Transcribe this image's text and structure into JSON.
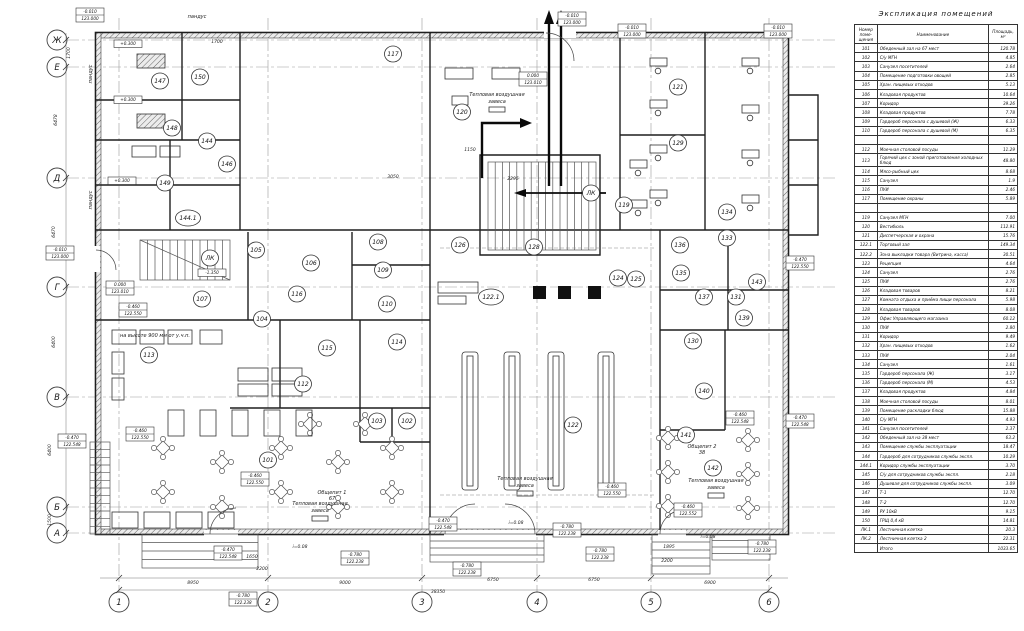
{
  "schedule": {
    "title": "Экспликация помещений",
    "headers": [
      "Номер поме- щения",
      "Наименование",
      "Площадь, м²"
    ],
    "rows": [
      [
        "101",
        "Обеденный зал на 67 мест",
        "120.78"
      ],
      [
        "102",
        "С/у МГН",
        "4.85"
      ],
      [
        "103",
        "Санузел посетителей",
        "2.64"
      ],
      [
        "104",
        "Помещение подготовки овощей",
        "2.85"
      ],
      [
        "105",
        "Хран. пищевых отходов",
        "5.13"
      ],
      [
        "106",
        "Кладовая продуктов",
        "10.64"
      ],
      [
        "107",
        "Коридор",
        "39.26"
      ],
      [
        "108",
        "Кладовая продуктов",
        "7.78"
      ],
      [
        "109",
        "Гардероб персонала с душевой (Ж)",
        "6.33"
      ],
      [
        "110",
        "Гардероб персонала с душевой (М)",
        "6.35"
      ],
      [
        "",
        "",
        ""
      ],
      [
        "112",
        "Моечная столовой посуды",
        "11.29"
      ],
      [
        "113",
        "Горячий цех с зоной приготовления холодных блюд",
        "48.80"
      ],
      [
        "114",
        "Мясо-рыбный цех",
        "8.68"
      ],
      [
        "115",
        "Санузел",
        "1.9"
      ],
      [
        "116",
        "ПУИ",
        "2.46"
      ],
      [
        "117",
        "Помещение охраны",
        "5.89"
      ],
      [
        "",
        "",
        ""
      ],
      [
        "119",
        "Санузел МГН",
        "7.00"
      ],
      [
        "120",
        "Вестибюль",
        "112.91"
      ],
      [
        "121",
        "Диспетчерская и охрана",
        "15.76"
      ],
      [
        "122.1",
        "Торговый зал",
        "149.34"
      ],
      [
        "122.2",
        "Зона выкладки товара (Витрина, касса)",
        "30.51"
      ],
      [
        "123",
        "Рецепция",
        "4.64"
      ],
      [
        "124",
        "Санузел",
        "2.76"
      ],
      [
        "125",
        "ПУИ",
        "2.76"
      ],
      [
        "126",
        "Кладовая товаров",
        "8.21"
      ],
      [
        "127",
        "Комната отдыха и приёма пищи персонала",
        "5.98"
      ],
      [
        "128",
        "Кладовая товаров",
        "8.08"
      ],
      [
        "129",
        "Офис Управляющего магазина",
        "60.12"
      ],
      [
        "130",
        "ПУИ",
        "2.80"
      ],
      [
        "131",
        "Коридор",
        "9.49"
      ],
      [
        "132",
        "Хран. пищевых отходов",
        "1.62"
      ],
      [
        "133",
        "ПУИ",
        "2.04"
      ],
      [
        "134",
        "Санузел",
        "1.61"
      ],
      [
        "135",
        "Гардероб персонала (Ж)",
        "3.17"
      ],
      [
        "136",
        "Гардероб персонала (М)",
        "4.53"
      ],
      [
        "137",
        "Кладовая продуктов",
        "4.84"
      ],
      [
        "138",
        "Моечная столовой посуды",
        "8.01"
      ],
      [
        "139",
        "Помещение раскладки блюд",
        "15.88"
      ],
      [
        "140",
        "С/у МГН",
        "4.93"
      ],
      [
        "141",
        "Санузел посетителей",
        "2.37"
      ],
      [
        "142",
        "Обеденный зал на 38 мест",
        "63.2"
      ],
      [
        "143",
        "Помещение службы эксплуатации",
        "18.47"
      ],
      [
        "144",
        "Гардероб для сотрудников службы экспл.",
        "10.29"
      ],
      [
        "144.1",
        "Коридор службы эксплуатации",
        "3.70"
      ],
      [
        "145",
        "С/у для сотрудников службы экспл.",
        "2.18"
      ],
      [
        "146",
        "Душевая для сотрудников службы экспл.",
        "3.09"
      ],
      [
        "147",
        "Т-1",
        "12.70"
      ],
      [
        "148",
        "Т-2",
        "12.70"
      ],
      [
        "149",
        "РУ 10кВ",
        "9.15"
      ],
      [
        "150",
        "ГРЩ 0,4 кВ",
        "14.81"
      ],
      [
        "ЛК.1",
        "Лестничная клетка",
        "20.3"
      ],
      [
        "ЛК.2",
        "Лестничная клетка 2",
        "22.31"
      ]
    ],
    "total": {
      "label": "Итого",
      "value": "1033.65"
    }
  },
  "plan": {
    "grid_letters": [
      [
        "Ж",
        40
      ],
      [
        "Е",
        67
      ],
      [
        "Д",
        178
      ],
      [
        "Г",
        287
      ],
      [
        "В",
        397
      ],
      [
        "Б",
        507
      ],
      [
        "А",
        533
      ]
    ],
    "grid_numbers": [
      [
        "1",
        119
      ],
      [
        "2",
        268
      ],
      [
        "3",
        422
      ],
      [
        "4",
        537
      ],
      [
        "5",
        651
      ],
      [
        "6",
        769
      ]
    ],
    "room_tags": [
      [
        "147",
        160,
        81
      ],
      [
        "150",
        200,
        77
      ],
      [
        "148",
        172,
        128
      ],
      [
        "144",
        207,
        141
      ],
      [
        "146",
        227,
        164
      ],
      [
        "149",
        165,
        183
      ],
      [
        "144.1",
        188,
        218
      ],
      [
        "117",
        393,
        54
      ],
      [
        "120",
        462,
        112
      ],
      [
        "121",
        678,
        87
      ],
      [
        "129",
        678,
        143
      ],
      [
        "119",
        624,
        205
      ],
      [
        "ЛК",
        591,
        193
      ],
      [
        "ЛК",
        210,
        258
      ],
      [
        "105",
        256,
        250
      ],
      [
        "106",
        311,
        263
      ],
      [
        "108",
        378,
        242
      ],
      [
        "109",
        383,
        270
      ],
      [
        "110",
        387,
        304
      ],
      [
        "107",
        202,
        299
      ],
      [
        "116",
        297,
        294
      ],
      [
        "104",
        262,
        319
      ],
      [
        "115",
        327,
        348
      ],
      [
        "113",
        149,
        355
      ],
      [
        "112",
        303,
        384
      ],
      [
        "114",
        397,
        342
      ],
      [
        "103",
        377,
        421
      ],
      [
        "102",
        407,
        421
      ],
      [
        "101",
        268,
        460
      ],
      [
        "126",
        460,
        245
      ],
      [
        "128",
        534,
        247
      ],
      [
        "122.1",
        491,
        297
      ],
      [
        "124",
        618,
        278
      ],
      [
        "125",
        636,
        279
      ],
      [
        "136",
        680,
        245
      ],
      [
        "135",
        681,
        273
      ],
      [
        "122",
        573,
        425
      ],
      [
        "137",
        704,
        297
      ],
      [
        "131",
        736,
        297
      ],
      [
        "139",
        744,
        318
      ],
      [
        "130",
        693,
        341
      ],
      [
        "134",
        727,
        212
      ],
      [
        "133",
        727,
        238
      ],
      [
        "143",
        757,
        282
      ],
      [
        "140",
        704,
        391
      ],
      [
        "141",
        686,
        435
      ],
      [
        "142",
        713,
        468
      ]
    ],
    "elevations": [
      [
        90,
        8,
        "-0.010",
        "123.000"
      ],
      [
        572,
        12,
        "-0.010",
        "123.000"
      ],
      [
        632,
        24,
        "-0.010",
        "123.000"
      ],
      [
        778,
        24,
        "-0.010",
        "123.000"
      ],
      [
        128,
        40,
        "+0.300"
      ],
      [
        128,
        96,
        "+0.300"
      ],
      [
        122,
        177,
        "+0.300"
      ],
      [
        533,
        72,
        "0.000",
        "123.010"
      ],
      [
        60,
        246,
        "-0.010",
        "123.000"
      ],
      [
        120,
        281,
        "0.000",
        "123.010"
      ],
      [
        133,
        303,
        "-0.460",
        "122.550"
      ],
      [
        212,
        269,
        "-1.350"
      ],
      [
        72,
        434,
        "-0.470",
        "122.548"
      ],
      [
        140,
        427,
        "-0.460",
        "122.550"
      ],
      [
        255,
        472,
        "-0.460",
        "122.550"
      ],
      [
        800,
        256,
        "-0.470",
        "122.550"
      ],
      [
        800,
        414,
        "-0.470",
        "122.548"
      ],
      [
        740,
        411,
        "-0.460",
        "122.548"
      ],
      [
        612,
        483,
        "-0.460",
        "122.550"
      ],
      [
        688,
        503,
        "-0.460",
        "122.552"
      ],
      [
        228,
        546,
        "-0.470",
        "122.548"
      ],
      [
        243,
        592,
        "-0.780",
        "122.238"
      ],
      [
        355,
        551,
        "-0.780",
        "122.238"
      ],
      [
        443,
        517,
        "-0.470",
        "122.548"
      ],
      [
        467,
        562,
        "-0.780",
        "122.238"
      ],
      [
        567,
        523,
        "-0.780",
        "122.238"
      ],
      [
        600,
        547,
        "-0.780",
        "122.238"
      ],
      [
        762,
        540,
        "-0.780",
        "122.238"
      ]
    ],
    "annotations": [
      [
        197,
        18,
        "пандус",
        0
      ],
      [
        92,
        74,
        "пандус",
        -90
      ],
      [
        92,
        200,
        "пандус",
        -90
      ],
      [
        497,
        96,
        "Тепловая воздушная",
        0
      ],
      [
        497,
        103,
        "завеса",
        0
      ],
      [
        320,
        505,
        "Тепловая воздушная",
        0
      ],
      [
        320,
        512,
        "завеса",
        0
      ],
      [
        525,
        480,
        "Тепловая воздушная",
        0
      ],
      [
        525,
        487,
        "завеса",
        0
      ],
      [
        716,
        482,
        "Тепловая воздушная",
        0
      ],
      [
        716,
        489,
        "завеса",
        0
      ],
      [
        155,
        337,
        "на высоте 900 мм от у.ч.п.",
        0
      ],
      [
        332,
        494,
        "Общепит 1",
        0
      ],
      [
        332,
        500,
        "67",
        0
      ],
      [
        702,
        448,
        "Общепит 2",
        0
      ],
      [
        702,
        454,
        "38",
        0
      ]
    ],
    "dimensions": [
      [
        193,
        584,
        "8950",
        0
      ],
      [
        345,
        584,
        "9000",
        0
      ],
      [
        493,
        581,
        "6750",
        0
      ],
      [
        594,
        581,
        "6750",
        0
      ],
      [
        710,
        584,
        "6900",
        0
      ],
      [
        438,
        593,
        "38350",
        0
      ],
      [
        70,
        53,
        "1700",
        -90
      ],
      [
        57,
        120,
        "6478",
        -90
      ],
      [
        55,
        232,
        "6470",
        -90
      ],
      [
        55,
        342,
        "6400",
        -90
      ],
      [
        51,
        450,
        "6400",
        -90
      ],
      [
        51,
        520,
        "1500",
        -90
      ],
      [
        217,
        43,
        "1700",
        0
      ],
      [
        470,
        151,
        "1150",
        0
      ],
      [
        513,
        180,
        "2295",
        0
      ],
      [
        393,
        178,
        "3050",
        0
      ],
      [
        262,
        570,
        "2200",
        0
      ],
      [
        252,
        558,
        "1650",
        0
      ],
      [
        669,
        548,
        "1895",
        0
      ],
      [
        667,
        562,
        "2200",
        0
      ],
      [
        300,
        548,
        "i=0.08",
        0
      ],
      [
        516,
        524,
        "i=0.08",
        0
      ],
      [
        708,
        538,
        "i=0.08",
        0
      ]
    ]
  }
}
